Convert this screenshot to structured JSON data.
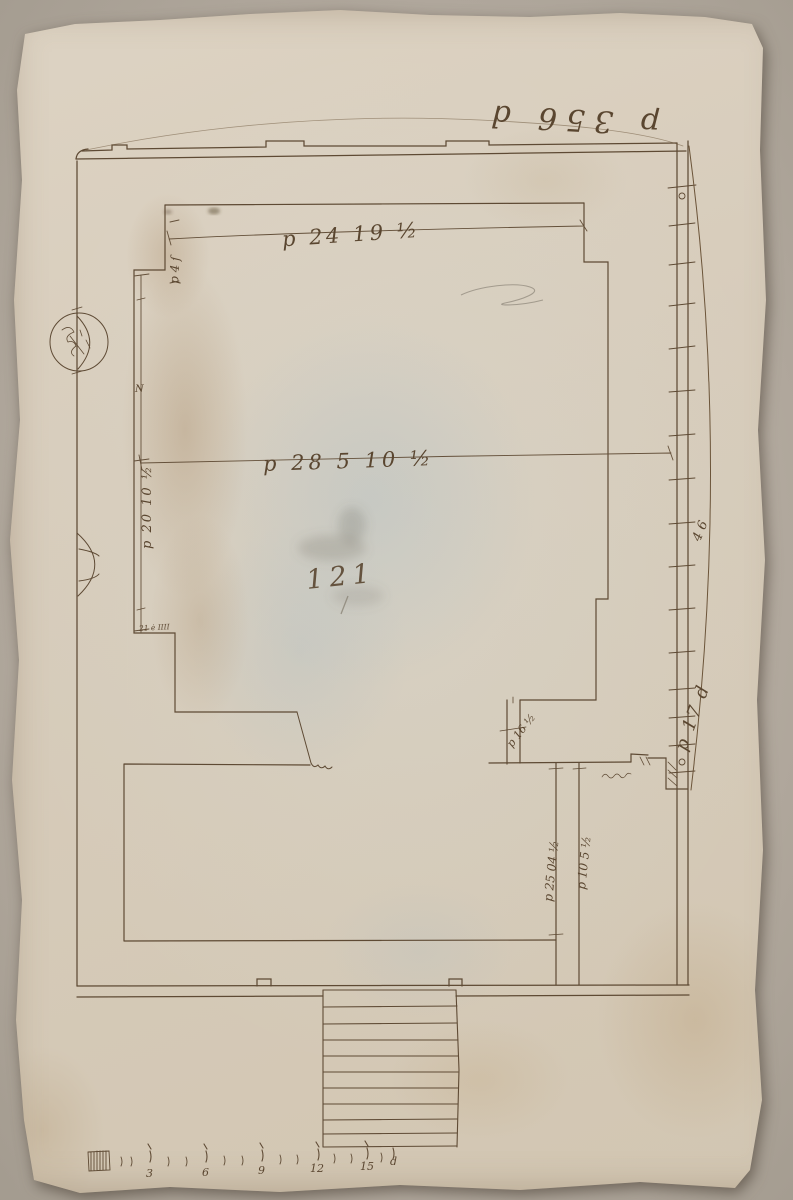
{
  "annotations": {
    "top_right": "p 356 d",
    "upper_width": "p 24 19 ½",
    "hall_width": "p 28 5 10 ½",
    "left_height": "p 20 10 ½",
    "left_height_mark": "N",
    "upper_left": "p 4 ſ",
    "right_mid": "4 6",
    "right_lower": "p 17 d",
    "inner_corner": "21 ė IIII",
    "passage": "p 16 ½",
    "lower_dim_a": "p 25 04 ½",
    "lower_dim_b": "p 10 5 ½",
    "pencil_number": "121"
  },
  "scale_bar": {
    "tick_labels": [
      "3",
      "6",
      "9",
      "12",
      "15"
    ],
    "end_label": "d"
  },
  "colors": {
    "ink": "#5e4a34",
    "pencil": "#8b8477",
    "paper": "#d8cebf",
    "background": "#b3aa9f"
  }
}
